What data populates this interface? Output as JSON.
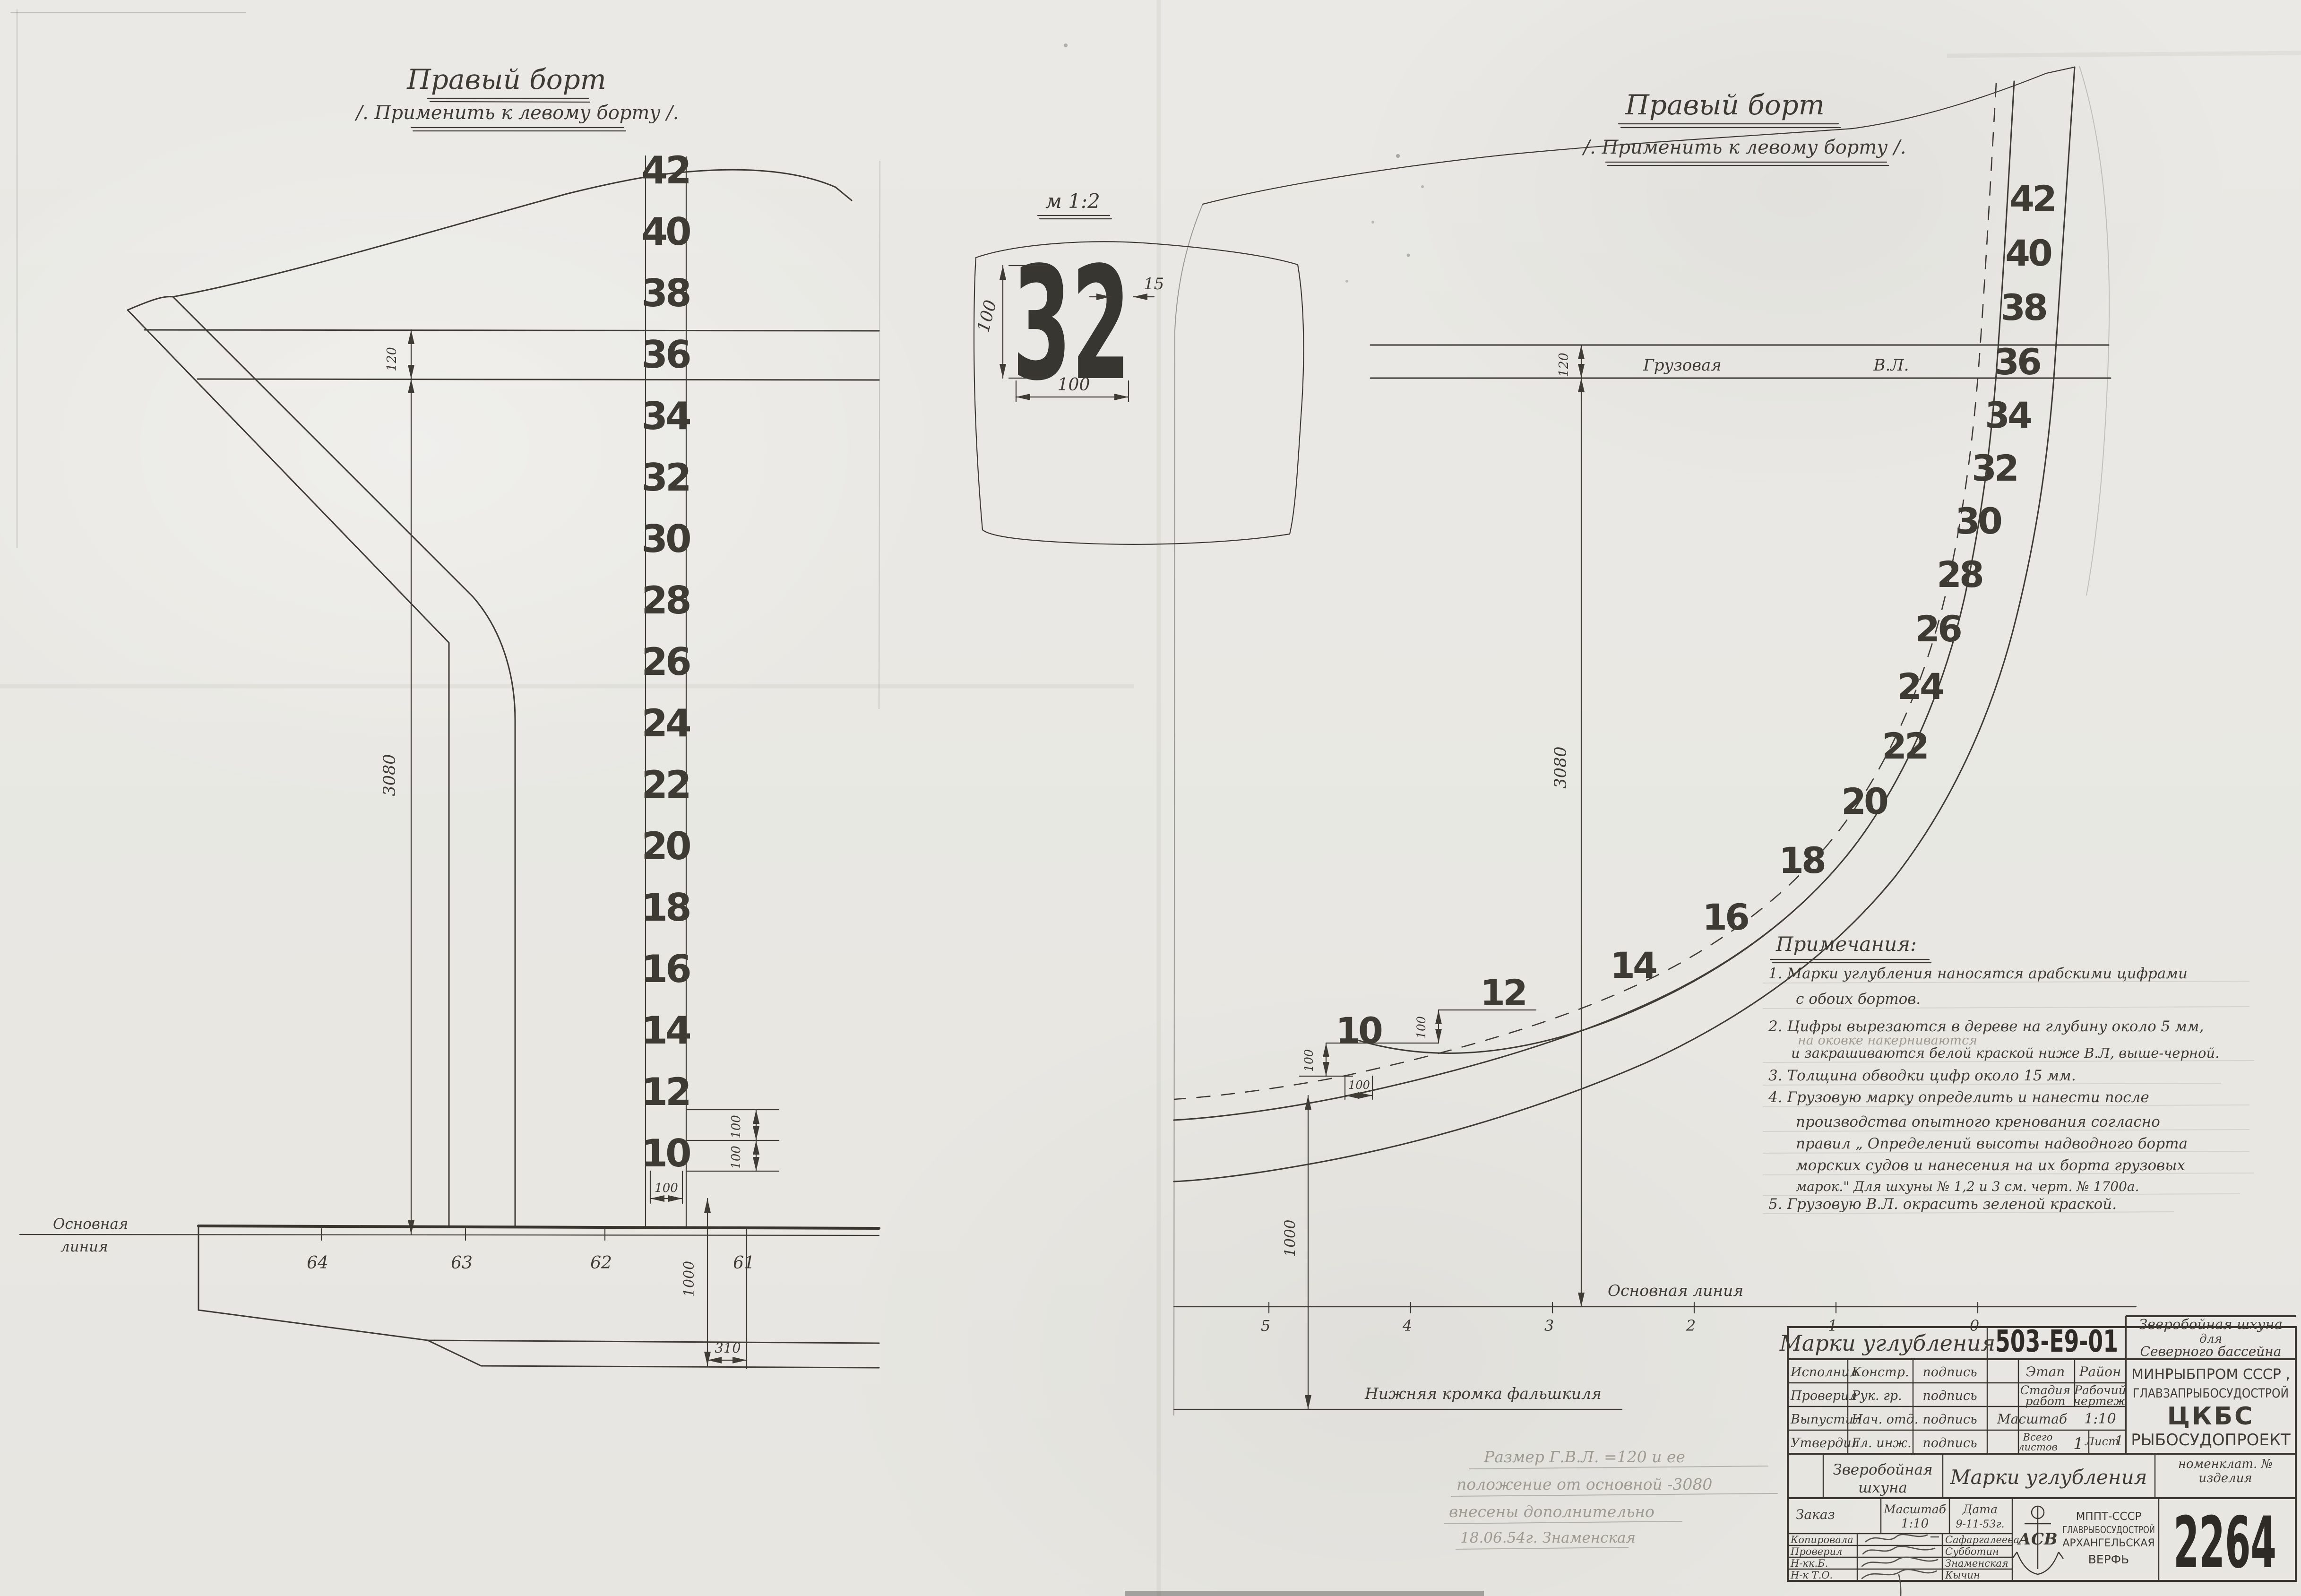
{
  "left_view": {
    "title": "Правый борт",
    "subtitle": "/. Применить к левому борту /.",
    "numbers": [
      "42",
      "40",
      "38",
      "36",
      "34",
      "32",
      "30",
      "28",
      "26",
      "24",
      "22",
      "20",
      "18",
      "16",
      "14",
      "12",
      "10"
    ],
    "dim_waterline_band": "120",
    "dim_height_to_wl": "3080",
    "dim_step_upper": "100",
    "dim_step_lower": "100",
    "dim_digit_width": "100",
    "dim_keel_offset": "1000",
    "dim_310": "310",
    "baseline_word1": "Основная",
    "baseline_word2": "линия",
    "stations": [
      "64",
      "63",
      "62",
      "61"
    ]
  },
  "detail": {
    "scale_label": "м 1:2",
    "mark": "32",
    "dim_height": "100",
    "dim_width": "100",
    "dim_stroke": "15"
  },
  "right_view": {
    "title": "Правый борт",
    "subtitle": "/. Применить к левому борту /.",
    "numbers": [
      "42",
      "40",
      "38",
      "36",
      "34",
      "32",
      "30",
      "28",
      "26",
      "24",
      "22",
      "20",
      "18",
      "16",
      "14",
      "12",
      "10"
    ],
    "load_wl_word1": "Грузовая",
    "load_wl_word2": "В.Л.",
    "dim_waterline_band": "120",
    "dim_height_to_wl": "3080",
    "dim_step_upper": "100",
    "dim_step_lower": "100",
    "dim_digit_width": "100",
    "dim_keel_offset": "1000",
    "baseline_label": "Основная линия",
    "false_keel_label": "Нижняя кромка фальшкиля",
    "stations": [
      "5",
      "4",
      "3",
      "2",
      "1",
      "0"
    ]
  },
  "notes": {
    "heading": "Примечания:",
    "line1a": "1. Марки углубления наносятся арабскими цифрами",
    "line1b": "с обоих бортов.",
    "line2a": "2. Цифры вырезаются в дереве на глубину около 5 мм,",
    "line2_pencil": "на оковке накерниваются",
    "line2b": "и закрашиваются белой краской ниже В.Л, выше-черной.",
    "line3": "3. Толщина обводки цифр около 15 мм.",
    "line4a": "4. Грузовую марку определить и нанести после",
    "line4b": "производства опытного кренования согласно",
    "line4c": "правил „ Определений высоты надводного борта",
    "line4d": "морских судов и нанесения на их борта грузовых",
    "line4e": "марок.\" Для шхуны № 1,2 и 3 см. черт. № 1700а.",
    "line5": "5. Грузовую В.Л. окрасить зеленой краской."
  },
  "pencil_note": {
    "line1": "Размер Г.В.Л. =120 и ее",
    "line2": "положение от основной -3080",
    "line3": "внесены дополнительно",
    "line4": "18.06.54г.  Знаменская"
  },
  "title_block": {
    "doc_title": "Марки углубления",
    "doc_number": "503-Е9-01",
    "project_line1": "Зверобойная шхуна",
    "project_line2": "для",
    "project_line3": "Северного бассейна",
    "row_executed_label": "Исполнил",
    "row_executed_role": "Констр.",
    "row_executed_sig": "подпись",
    "row_checked_label": "Проверил",
    "row_checked_role": "Рук. гр.",
    "row_checked_sig": "подпись",
    "row_released_label": "Выпустил",
    "row_released_role": "Нач. отд.",
    "row_released_sig": "подпись",
    "row_approved_label": "Утвердил",
    "row_approved_role": "Гл. инж.",
    "row_approved_sig": "подпись",
    "etap_label": "Этап",
    "raion_label": "Район",
    "stage_line1": "Стадия",
    "stage_line2": "работ",
    "worktype_line1": "Рабочий",
    "worktype_line2": "чертеж",
    "scale_label": "Масштаб",
    "scale_value": "1:10",
    "total_sheets_line1": "Всего",
    "total_sheets_line2": "листов",
    "total_sheets_value": "1",
    "sheet_label": "Лист",
    "sheet_value": "1",
    "org_line1": "МИНРЫБПРОМ СССР ,",
    "org_line2": "ГЛАВЗАПРЫБОСУДОСТРОЙ",
    "org_line3": "ЦКБС",
    "org_line4": "РЫБОСУДОПРОЕКТ",
    "vessel_line1": "Зверобойная",
    "vessel_line2": "шхуна",
    "subject": "Марки углубления",
    "nomen_line1": "номенклат. №",
    "nomen_line2": "изделия",
    "order_label": "Заказ",
    "scale2_label": "Масштаб",
    "scale2_value": "1:10",
    "date_label": "Дата",
    "date_value": "9-11-53г.",
    "sig1_label": "Копировала",
    "sig1_name": "Сафаргалеева",
    "sig2_label": "Проверил",
    "sig2_name": "Субботин",
    "sig3_label": "Н-кк.Б.",
    "sig3_name": "Знаменская",
    "sig4_label": "Н-к Т.О.",
    "sig4_name": "Кычин",
    "yard_line1": "МППТ-СССР",
    "yard_line2": "ГЛАВРЫБОСУДОСТРОЙ",
    "yard_line3": "АРХАНГЕЛЬСКАЯ",
    "yard_line4": "ВЕРФЬ",
    "logo_letters": "АСВ",
    "registry_number": "2264"
  }
}
